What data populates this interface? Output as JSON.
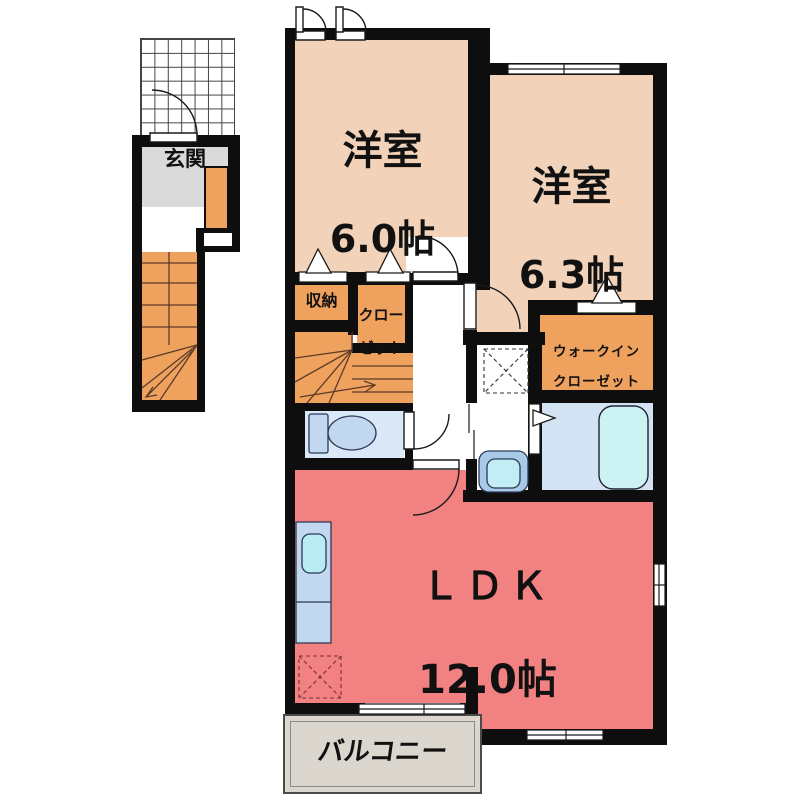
{
  "floorplan": {
    "type": "apartment-floor-plan",
    "rooms": {
      "genkan": {
        "label": "玄関"
      },
      "bedroom1": {
        "label": "洋室",
        "size": "6.0帖"
      },
      "bedroom2": {
        "label": "洋室",
        "size": "6.3帖"
      },
      "storage": {
        "label": "収納"
      },
      "closet": {
        "line1": "クロー",
        "line2": "ゼット"
      },
      "walk_in_closet": {
        "line1": "ウォークイン",
        "line2": "クローゼット"
      },
      "ldk": {
        "label": "ＬＤＫ",
        "size": "12.0帖"
      },
      "balcony": {
        "label": "バルコニー"
      }
    }
  },
  "colors": {
    "room_peach": "#f2d3b9",
    "closet_orange": "#efa25e",
    "ldk_pink": "#f28181",
    "toilet_blue": "#dbe8f7",
    "bath_blue": "#d4e3f4",
    "tub_cyan": "#ccf2f4",
    "fixture_blue": "#c2d7f0",
    "sink_cyan": "#b9ecf2",
    "basin_outer": "#a9c9e9",
    "basin_inner": "#c3edf4",
    "balcony_gray": "#dbd7cf",
    "genkan_gray": "#dadada",
    "wall_black": "#0e0e0e",
    "stair_line": "#5c3a28"
  }
}
